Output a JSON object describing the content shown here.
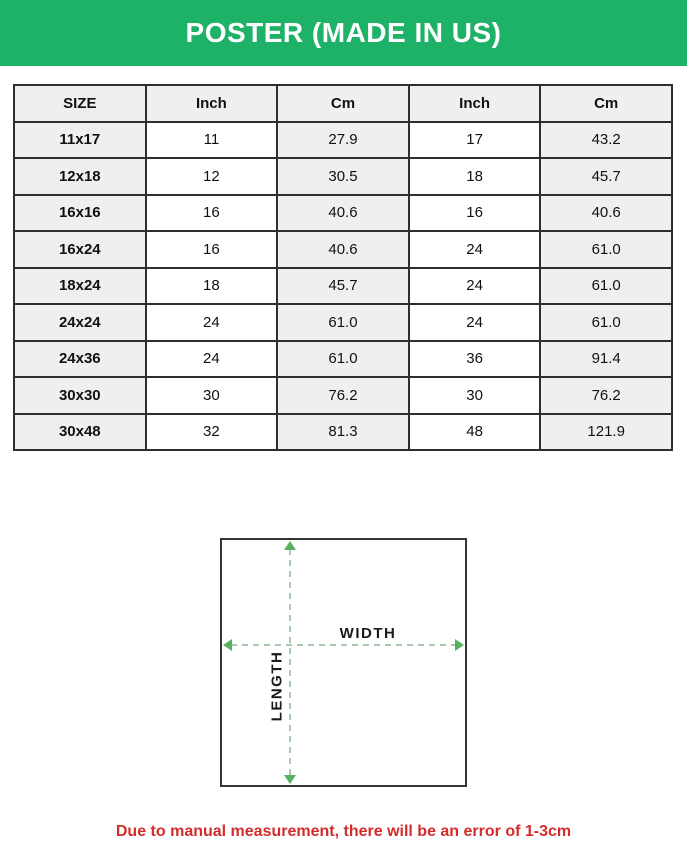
{
  "colors": {
    "banner_bg": "#1eb269",
    "banner_text": "#ffffff",
    "table_border": "#2e2e2e",
    "shaded_cell_bg": "#f0efef",
    "dash_line": "#a9c9ad",
    "arrow_green": "#57b15e",
    "note_red": "#d22c2c"
  },
  "header": {
    "title": "POSTER (MADE IN US)"
  },
  "table": {
    "columns": [
      "SIZE",
      "Inch",
      "Cm",
      "Inch",
      "Cm"
    ],
    "rows": [
      {
        "size": "11x17",
        "values": [
          "11",
          "27.9",
          "17",
          "43.2"
        ]
      },
      {
        "size": "12x18",
        "values": [
          "12",
          "30.5",
          "18",
          "45.7"
        ]
      },
      {
        "size": "16x16",
        "values": [
          "16",
          "40.6",
          "16",
          "40.6"
        ]
      },
      {
        "size": "16x24",
        "values": [
          "16",
          "40.6",
          "24",
          "61.0"
        ]
      },
      {
        "size": "18x24",
        "values": [
          "18",
          "45.7",
          "24",
          "61.0"
        ]
      },
      {
        "size": "24x24",
        "values": [
          "24",
          "61.0",
          "24",
          "61.0"
        ]
      },
      {
        "size": "24x36",
        "values": [
          "24",
          "61.0",
          "36",
          "91.4"
        ]
      },
      {
        "size": "30x30",
        "values": [
          "30",
          "76.2",
          "30",
          "76.2"
        ]
      },
      {
        "size": "30x48",
        "values": [
          "32",
          "81.3",
          "48",
          "121.9"
        ]
      }
    ]
  },
  "diagram": {
    "width_label": "WIDTH",
    "length_label": "LENGTH"
  },
  "footnote": {
    "text": "Due to manual measurement, there will be an error of 1-3cm"
  }
}
